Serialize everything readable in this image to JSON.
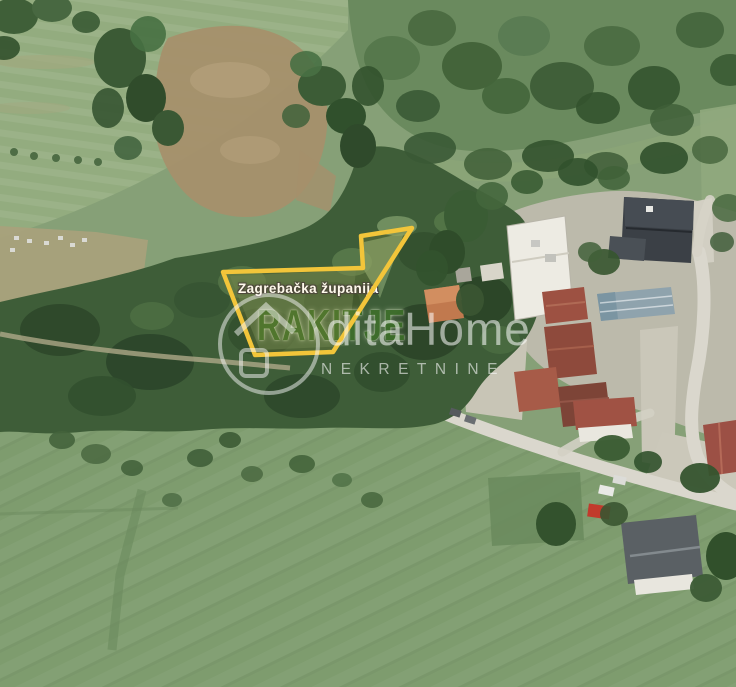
{
  "image": {
    "kind": "aerial-satellite-photo",
    "width": 736,
    "height": 687
  },
  "map_labels": {
    "county": "Zagrebačka županija",
    "settlement": "RAKITJE"
  },
  "watermark": {
    "brand": "ditaHome",
    "subtitle": "NEKRETNINE",
    "logo": "house-in-circle-icon"
  },
  "parcel": {
    "outline_points": "412,228 361,236 363,268 223,272 255,355 333,352",
    "outline_color": "#F2C53A"
  },
  "colors": {
    "parcel_outline": "#F2C53A",
    "county_label_text": "#FFFFFF",
    "settlement_label_text": "#3E6F2B",
    "watermark_text": "rgba(255,255,255,0.55)",
    "forest_green": "#3E5D38",
    "meadow_green": "#86A077",
    "road_gray": "#DAD7CD"
  }
}
